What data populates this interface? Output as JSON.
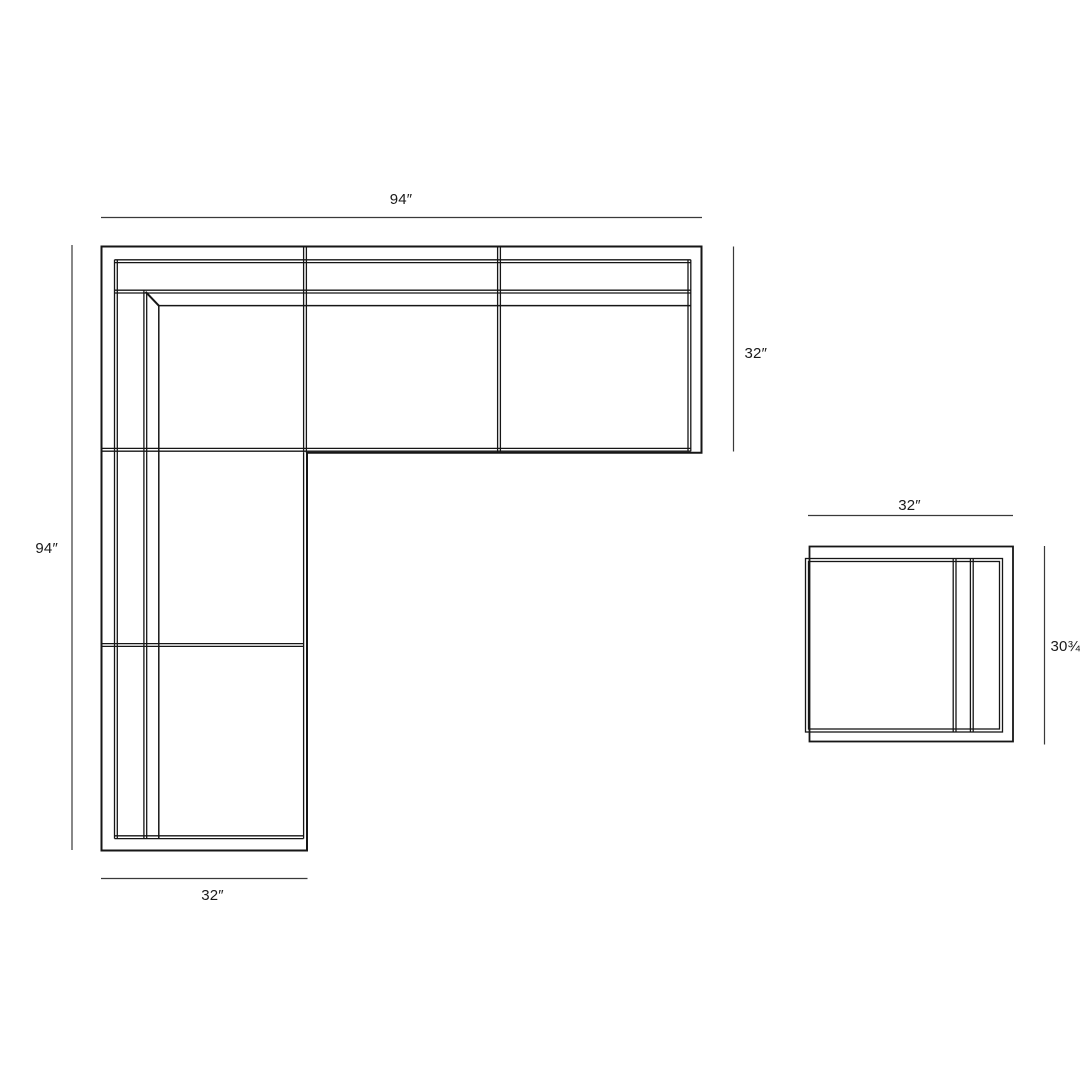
{
  "canvas": {
    "background": "#ffffff",
    "line_color": "#161616",
    "dimension_line_color": "#3a3a3a",
    "text_color": "#1a1a1a"
  },
  "diagram": {
    "type": "furniture-dimension-plan",
    "pieces": [
      {
        "name": "sectional-sofa",
        "shape": "L-shaped",
        "overall_width_in": 94,
        "overall_length_in": 94,
        "section_depth_in": 32
      },
      {
        "name": "armless-chair",
        "shape": "square",
        "width_in": 32,
        "depth_in": 30.75
      }
    ],
    "labels": {
      "sofa_top_width": "94″",
      "sofa_right_depth": "32″",
      "sofa_left_length": "94″",
      "sofa_bottom_width": "32″",
      "chair_top_width": "32″",
      "chair_right_depth": "30¾″"
    }
  }
}
